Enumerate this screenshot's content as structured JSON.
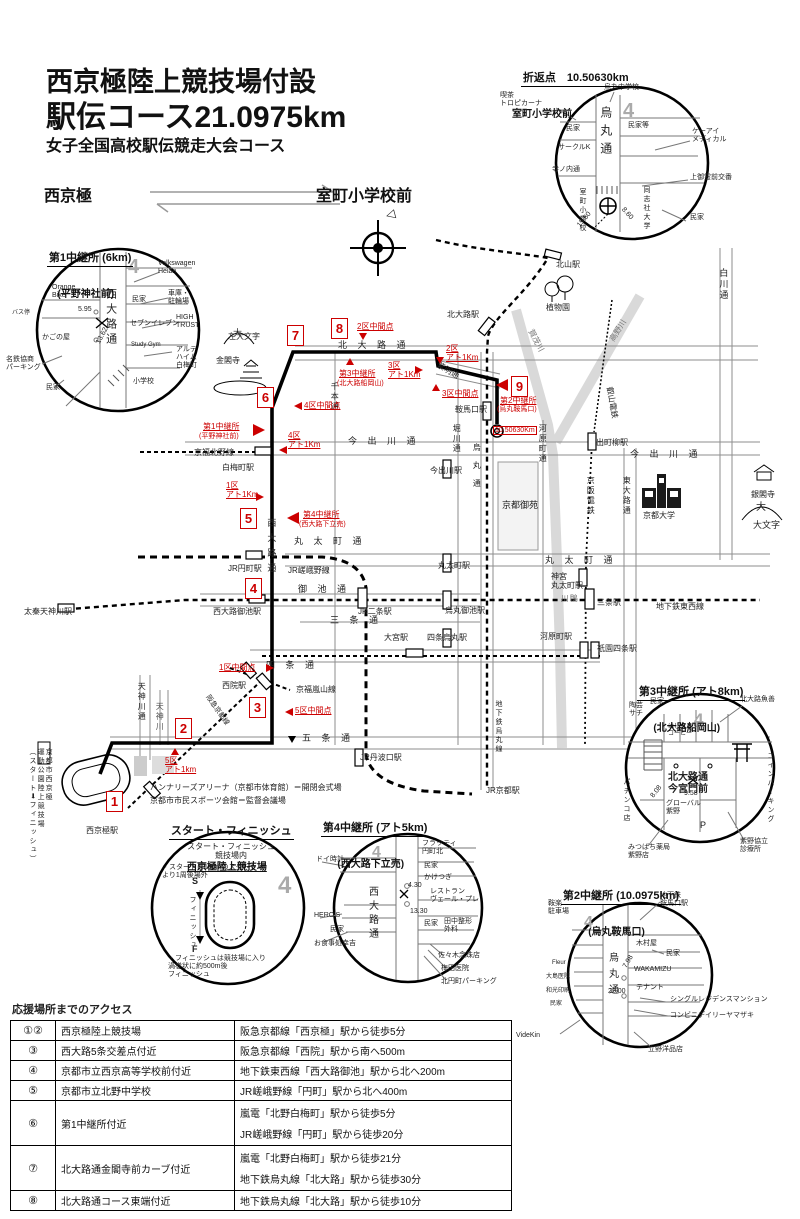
{
  "page": {
    "north": "4",
    "arrow_mark": "◁"
  },
  "title": {
    "line1": "西京極陸上競技場付設",
    "line2": "駅伝コース21.0975km",
    "line3": "女子全国高校駅伝競走大会コース"
  },
  "direction": {
    "left": "西京極",
    "right": "室町小学校前"
  },
  "turn_inset": {
    "title": "折返点　10.50630km",
    "subtitle": "室町小学校前",
    "cafe": "喫茶\nトロピカーナ",
    "school": "烏丸中学校",
    "karasuma": "烏丸通",
    "minka1": "民家",
    "minka2": "民家等",
    "circlek": "サークルK",
    "teranouchi": "寺ノ内通",
    "keai": "ケーアイ\nメディカル",
    "koban": "上御霊前交番",
    "muromachi": "室町小学校",
    "doshisha": "同志社大学",
    "minka3": "民家",
    "w1": "15.60",
    "w2": "8.60"
  },
  "relay1_inset": {
    "title": "第1中継所 (6km)",
    "subtitle": "(平野神社前)",
    "vw": "Volkswagen\nHeian",
    "orange": "Orange\nBike",
    "nishioji": "西大路通",
    "minka1": "民家",
    "garage": "車庫・\n駐輪場",
    "seven": "セブンイレブン",
    "high": "HIGH\nTRUST",
    "gym": "Study Gym",
    "arte": "アルテ\nハイム\n白梅町",
    "kago": "かごの屋",
    "bus": "バス停",
    "meitetsu": "名鉄協商\nパーキング",
    "minka2": "民家",
    "school": "小学校",
    "w1": "5.95",
    "w2": "13.62"
  },
  "relay3_inset": {
    "title": "第3中継所 (アト8km)",
    "subtitle": "(北大路船岡山)",
    "minka": "民家",
    "sachi": "陶芸\nサチ",
    "hashimoto": "はしもと\nコーヒー",
    "uozen": "北大路魚善",
    "kitaoji": "北大路通\n今宮門前",
    "global": "グローバル\n紫野",
    "pachinko": "パチンコ店",
    "coin": "コインパーキング",
    "p": "P",
    "mitsubachi": "みつばち薬局\n紫野店",
    "kyoritsu": "紫野協立\n診療所",
    "w1": "8.08",
    "w2": "9.58"
  },
  "relay4_inset": {
    "title": "第4中継所 (アト5km)",
    "subtitle": "(西大路下立売)",
    "doi": "ドイ時計",
    "flatty": "フラッティ\n円町北",
    "minka1": "民家",
    "kaketsugi": "かけつぎ",
    "restaurant": "レストラン\nヴェール・プレ",
    "nishioji": "西大路通",
    "heros": "HERO'S",
    "minka2": "民家",
    "koukichi": "お食事処幸吉",
    "minka3": "民家",
    "tanaka": "田中整形\n外科",
    "sasaki": "佐々木念珠店",
    "umeda": "梅田医院",
    "parking": "北円町パーキング",
    "w1": "4.30",
    "w2": "13.30"
  },
  "relay2_inset": {
    "title": "第2中継所 (10.0975km)",
    "subtitle": "(烏丸鞍馬口)",
    "chikatetsu": "地下鉄\n鞍馬口駅",
    "anraku": "鞍楽\n駐車場",
    "kimuraya": "木村屋",
    "minka1": "民家",
    "fleur": "Fleur",
    "oshima": "大島医院",
    "wako": "和光印刷",
    "minka2": "民家",
    "wakamizu": "WAKAMIZU",
    "tenant": "テナント",
    "mansion": "シングルレジデンスマンション",
    "conbini": "コンビニデイリーヤマザキ",
    "tateno": "立野洋品店",
    "videkin": "VideKin",
    "karasuma": "烏丸通",
    "w1": "7.98",
    "w2": "22.00"
  },
  "sf_inset": {
    "title": "スタート・フィニッシュ",
    "subtitle": "西京極陸上競技場",
    "head": "スタート・フィニッシュ\n競技場内",
    "note1": "・スタートは100mのスタート\n より1周後場外",
    "s": "S",
    "f": "F",
    "finish": "フィニッシュ",
    "note2": "・フィニッシュは競技場に入り\n 渦巻状に約500m後\n フィニッシュ"
  },
  "map": {
    "streets": {
      "kitaoji": "北 大 路 通",
      "shimei": "紫明通",
      "imadegawa": "今 出 川 通",
      "marutamachi": "丸 太 町 通",
      "oike": "御 池 通",
      "sanjo": "三 条 通",
      "shijo": "四 条 通",
      "gojo": "五 条 通",
      "senbon": "千本通",
      "horikawa": "堀川通",
      "karasuma": "烏丸通",
      "kawaramachi": "河原町通",
      "higashioji": "東大路通",
      "shirakawa": "白川通",
      "tenjingawa_st": "天神川通",
      "nishioji": "西大路通"
    },
    "rivers": {
      "tenjin": "天神川",
      "kamo_upper": "賀茂川",
      "takano": "高野川",
      "kamo": "鴨\n川"
    },
    "rails": {
      "karasuma_line": "地下鉄烏丸線",
      "tozai": "地下鉄東西線",
      "sagano": "JR嵯峨野線",
      "kitano": "京福北野線",
      "arashiyama": "京福嵐山線",
      "hankyu": "阪急京都線",
      "keihan": "京阪電鉄",
      "eizan": "叡山電鉄"
    },
    "stations": {
      "kitaoji": "北大路駅",
      "kitayama": "北山駅",
      "kuramaguchi": "鞍馬口駅",
      "imadegawa": "今出川駅",
      "marutamachi": "丸太町駅",
      "karasumaoike": "烏丸御池駅",
      "shijokarasuma": "四条烏丸駅",
      "omiya": "大宮駅",
      "nijo": "JR二条駅",
      "enmachi": "JR円町駅",
      "hakubaicho": "白梅町駅",
      "nishiojioike": "西大路御池駅",
      "uzumasa": "太秦天神川駅",
      "saiin": "西院駅",
      "tanbaguchi": "JR丹波口駅",
      "kyoto": "JR京都駅",
      "demachi": "出町柳駅",
      "jingumarutamachi": "神宮\n丸太町駅",
      "sanjo": "三条駅",
      "gionshijo": "祇園四条駅",
      "kawaramachi": "河原町駅",
      "nishikyogoku": "西京極駅"
    },
    "places": {
      "sadaimonji": "左大文字",
      "dai1": "大",
      "kinkakuji": "金閣寺",
      "shokubutsuen": "植物園",
      "gosho": "京都御苑",
      "kyodai": "京都大学",
      "ginkakuji": "銀閣寺",
      "daimonji": "大文字",
      "arena": "ハンナリーズアリーナ（京都市体育館）＝開閉会式場",
      "sports": "京都市市民スポーツ会館＝監督会議場",
      "stadium": "京都市西京極\n運動公園陸上競技場\n（スタート➡フィニッシュ）"
    },
    "red": {
      "n1": "1",
      "n2": "2",
      "n3": "3",
      "n4": "4",
      "n5": "5",
      "n6": "6",
      "n7": "7",
      "n8": "8",
      "n9": "9",
      "relay1": "第1中継所",
      "relay1s": "(平野神社前)",
      "relay2": "第2中継所",
      "relay2s": "(烏丸鞍馬口)",
      "relay3": "第3中継所",
      "relay3s": "(北大路船岡山)",
      "relay4": "第4中継所",
      "relay4s": "(西大路下立売)",
      "dist": "10.50630Km",
      "mid1": "1区中間点",
      "mid2": "2区中間点",
      "mid3": "3区中間点",
      "mid4": "4区中間点",
      "mid5": "5区中間点",
      "ato1": "1区\nアト1Km",
      "ato2": "2区\nアト1Km",
      "ato3": "3区\nアト1Km",
      "ato4": "4区\nアト1Km",
      "ato5": "5区\nアト1km"
    }
  },
  "access": {
    "title": "応援場所までのアクセス",
    "rows": [
      {
        "num": "①②",
        "place": "西京極陸上競技場",
        "a1": "阪急京都線「西京極」駅から徒歩5分",
        "a2": ""
      },
      {
        "num": "③",
        "place": "西大路5条交差点付近",
        "a1": "阪急京都線「西院」駅から南へ500m",
        "a2": ""
      },
      {
        "num": "④",
        "place": "京都市立西京高等学校前付近",
        "a1": "地下鉄東西線「西大路御池」駅から北へ200m",
        "a2": ""
      },
      {
        "num": "⑤",
        "place": "京都市立北野中学校",
        "a1": "JR嵯峨野線「円町」駅から北へ400m",
        "a2": ""
      },
      {
        "num": "⑥",
        "place": "第1中継所付近",
        "a1": "嵐電「北野白梅町」駅から徒歩5分",
        "a2": "JR嵯峨野線「円町」駅から徒歩20分"
      },
      {
        "num": "⑦",
        "place": "北大路通金閣寺前カーブ付近",
        "a1": "嵐電「北野白梅町」駅から徒歩21分",
        "a2": "地下鉄烏丸線「北大路」駅から徒歩30分"
      },
      {
        "num": "⑧",
        "place": "北大路通コース東端付近",
        "a1": "地下鉄烏丸線「北大路」駅から徒歩10分",
        "a2": ""
      }
    ]
  }
}
